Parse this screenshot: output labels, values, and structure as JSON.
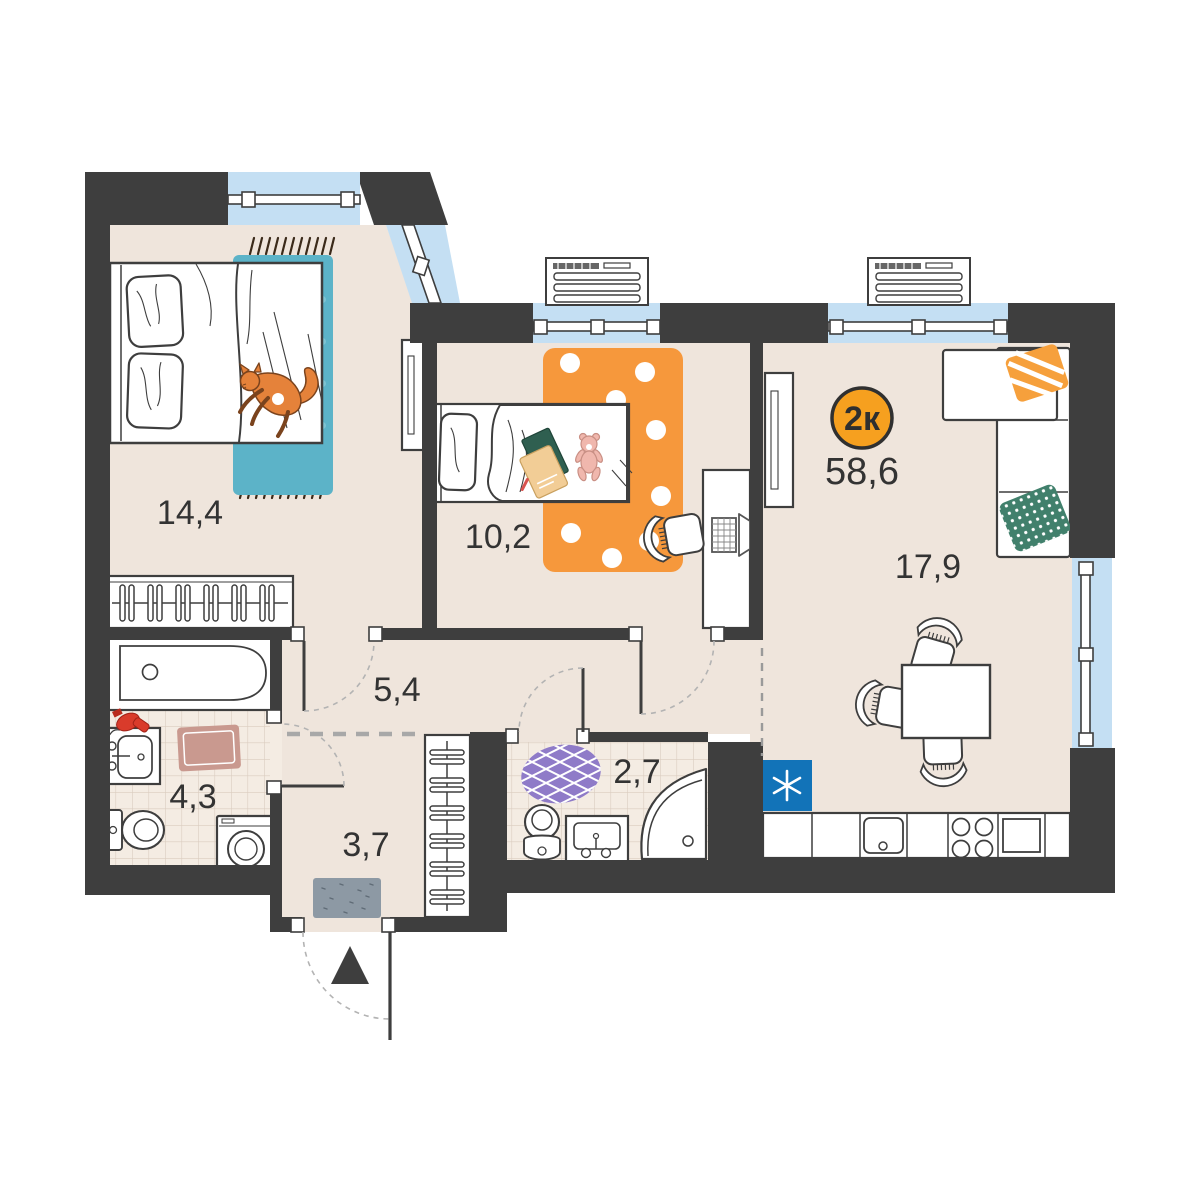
{
  "plan": {
    "badge": {
      "label": "2к",
      "total_area": "58,6"
    },
    "rooms": [
      {
        "name": "bedroom",
        "area": "14,4"
      },
      {
        "name": "kids_bedroom",
        "area": "10,2"
      },
      {
        "name": "living_kitchen",
        "area": "17,9"
      },
      {
        "name": "corridor",
        "area": "5,4"
      },
      {
        "name": "bathroom",
        "area": "4,3"
      },
      {
        "name": "wc",
        "area": "2,7"
      },
      {
        "name": "hallway",
        "area": "3,7"
      }
    ],
    "icons": {
      "fridge": "snowflake-asterisk",
      "entrance": "up-triangle-arrow"
    },
    "colors": {
      "wall": "#3E3E3E",
      "floor": "#EFE5DC",
      "window": "#C4DFF3",
      "badge_orange": "#F6A01F",
      "fridge_blue": "#1273B8",
      "rug_teal": "#5CB3C8",
      "rug_orange": "#F6983C",
      "rug_purple": "#8F7BC8",
      "pillow_green": "#41806C",
      "mat_pink": "#C9998F",
      "doormat_gray": "#8D99A4",
      "cat_orange": "#E5823A"
    }
  }
}
